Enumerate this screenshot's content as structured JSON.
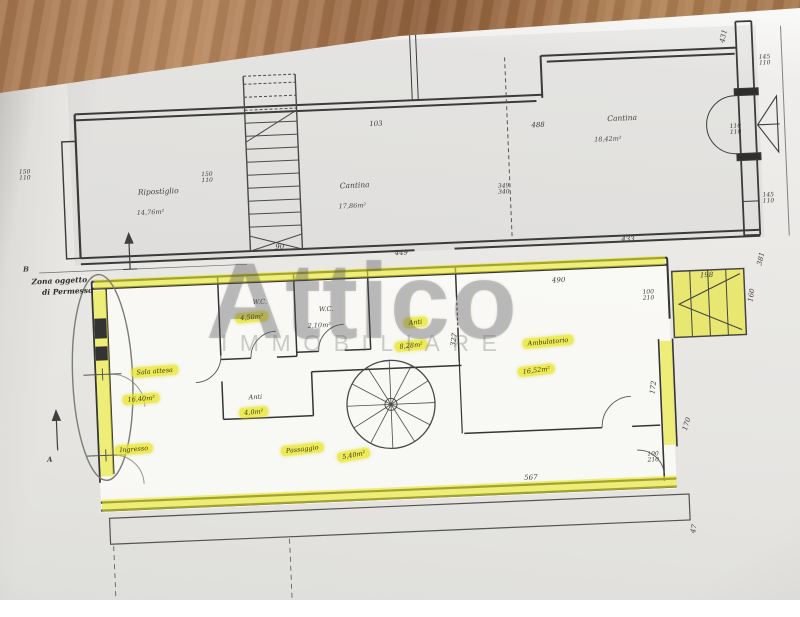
{
  "brand": {
    "title": "Attico",
    "subtitle": "IMMOBILIARE"
  },
  "notes": {
    "zone1": "Zona oggetto",
    "zone2": "di Permesso",
    "marker_a": "A",
    "marker_b": "B"
  },
  "upper": {
    "ripostiglio": {
      "name": "Ripostiglio",
      "area": "14,76m²"
    },
    "cantina1": {
      "name": "Cantina",
      "area": "17,86m²"
    },
    "cantina2": {
      "name": "Cantina",
      "area": "18,42m²"
    },
    "dims": {
      "w1061": "1061",
      "w103": "103",
      "w488": "488",
      "h431": "431",
      "r1a": "145",
      "r1b": "110",
      "r2a": "110",
      "r2b": "110",
      "r3a": "145",
      "r3b": "110",
      "l1a": "150",
      "l1b": "110",
      "l2a": "150",
      "l2b": "110",
      "mid_a": "349",
      "mid_b": "340",
      "w449": "449",
      "w433": "433",
      "h381": "381",
      "w490": "490",
      "w90": "90"
    }
  },
  "lower": {
    "wc1": {
      "name": "W.C.",
      "area": "4,50m²"
    },
    "wc2": {
      "name": "W.C.",
      "area": "2,10m²"
    },
    "anti1": {
      "name": "Anti",
      "area": "4,0m²"
    },
    "anti2": {
      "name": "Anti",
      "area": "8,28m²"
    },
    "ambulatorio": {
      "name": "Ambulatorio",
      "area": "16,52m²"
    },
    "sala": {
      "name": "Sala attesa",
      "area": "16,40m²"
    },
    "ingresso": {
      "name": "Ingresso"
    },
    "passaggio": {
      "name": "Passaggio",
      "area": "5,40m²"
    },
    "dims": {
      "w198": "198",
      "h160": "160",
      "da": "100",
      "db": "210",
      "h327": "327",
      "h172": "172",
      "h170": "170",
      "dc": "100",
      "dd": "210",
      "w567": "567",
      "h47": "47"
    }
  }
}
